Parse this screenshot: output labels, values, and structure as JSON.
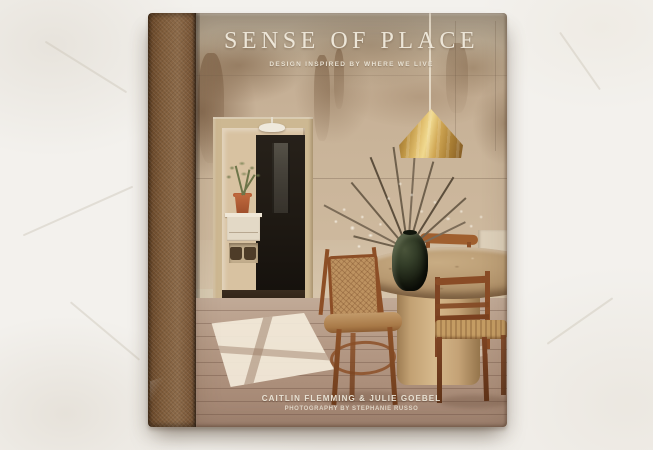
{
  "cover": {
    "title": "SENSE OF PLACE",
    "subtitle": "DESIGN INSPIRED BY WHERE WE LIVE",
    "authors": "CAITLIN FLEMMING & JULIE GOEBEL",
    "photo_credit": "PHOTOGRAPHY BY STEPHANIE RUSSO"
  },
  "colors": {
    "background_plaster": "#f3f1ed",
    "spine_cloth_brown": "#7a5737",
    "cover_wall_plaster": "#c7b196",
    "patina_brown": "#7c5c40",
    "brass_pendant": "#d1a855",
    "travertine_table": "#b3946c",
    "chair_wood": "#96562a",
    "floor_wood": "#b0967f",
    "title_text": "#ede6d8"
  }
}
